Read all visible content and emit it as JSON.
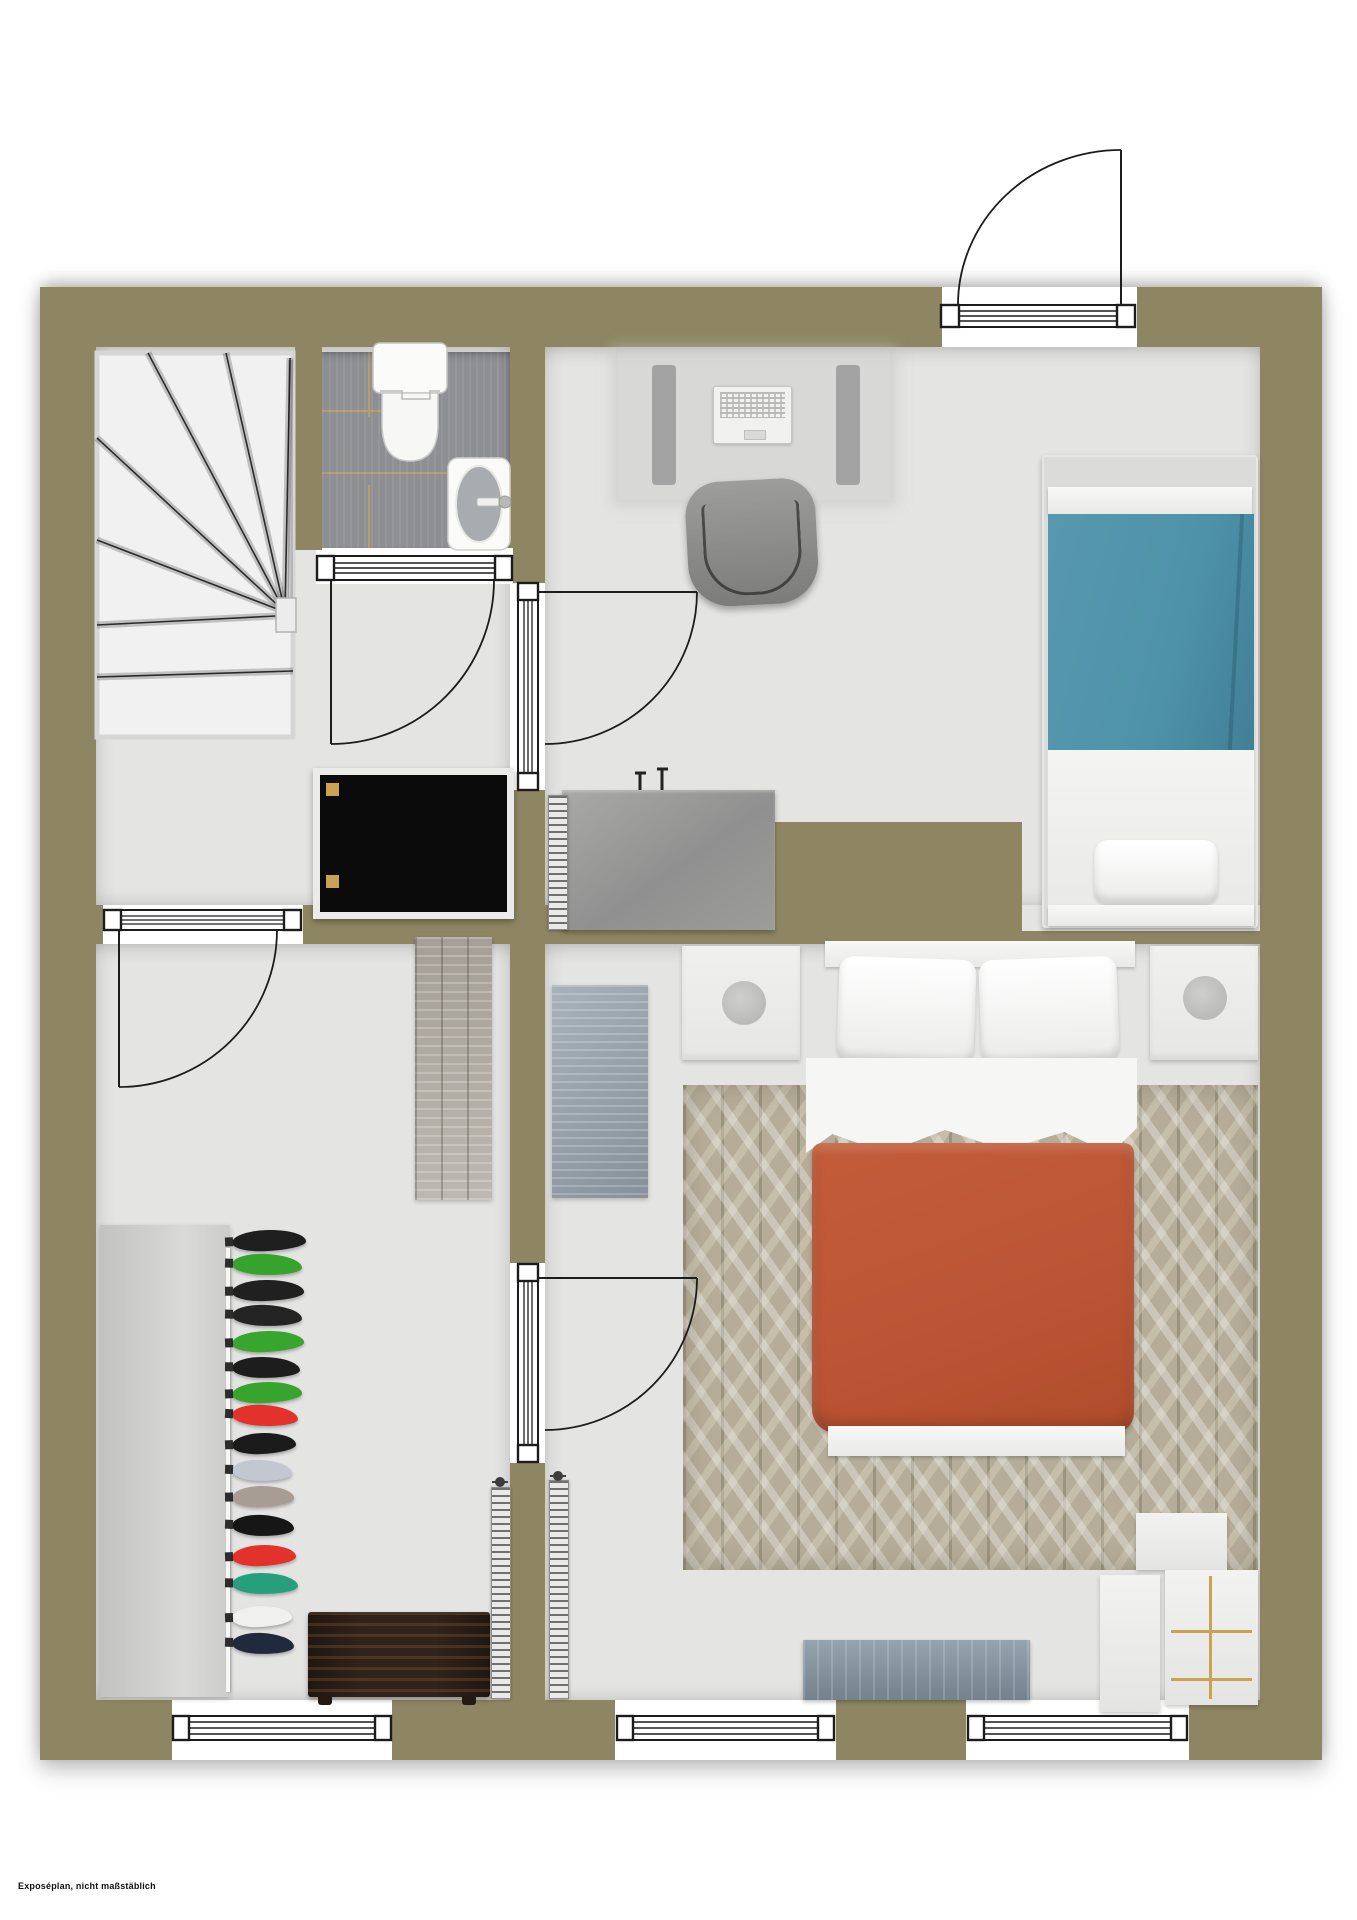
{
  "meta": {
    "disclaimer": "Exposéplan, nicht maßstäblich"
  },
  "palette": {
    "wall": "#8e8662",
    "floor": "#e4e4e3",
    "tile": "#8d8f93",
    "grout": "#b79c6c",
    "stair": "#f1f1f1",
    "bed_blue": "#4e92a9",
    "bed_orange": "#bc5535",
    "rug_bg": "#b5ad99",
    "wood": "#b5b0a8",
    "mat_blue": "#95a1ac",
    "cabinet": "#0b0b0b",
    "brass": "#c9a254",
    "chest": "#31231a",
    "table_blue": "#8494a1"
  },
  "icons": [
    "door-swing-icon",
    "window-sill-icon",
    "staircase-icon",
    "toilet-icon",
    "sink-icon",
    "radiator-icon",
    "lamp-icon",
    "clothes-hanger-icon"
  ],
  "clothes": {
    "items": [
      {
        "y": 2,
        "w": 74,
        "rot": -2,
        "color": "#1e1e1e"
      },
      {
        "y": 26,
        "w": 70,
        "rot": 2,
        "color": "#35a32c"
      },
      {
        "y": 52,
        "w": 72,
        "rot": -1,
        "color": "#202020"
      },
      {
        "y": 77,
        "w": 70,
        "rot": 2,
        "color": "#242424"
      },
      {
        "y": 103,
        "w": 72,
        "rot": -2,
        "color": "#38a52e"
      },
      {
        "y": 129,
        "w": 68,
        "rot": 1,
        "color": "#1d1d1d"
      },
      {
        "y": 154,
        "w": 70,
        "rot": -2,
        "color": "#36a42d"
      },
      {
        "y": 177,
        "w": 66,
        "rot": 3,
        "color": "#e2322b"
      },
      {
        "y": 205,
        "w": 64,
        "rot": -2,
        "color": "#1b1b1b"
      },
      {
        "y": 232,
        "w": 60,
        "rot": 2,
        "color": "#c2c7d2"
      },
      {
        "y": 258,
        "w": 62,
        "rot": -1,
        "color": "#a79d95"
      },
      {
        "y": 287,
        "w": 62,
        "rot": 2,
        "color": "#161616"
      },
      {
        "y": 317,
        "w": 64,
        "rot": -2,
        "color": "#e2322b"
      },
      {
        "y": 345,
        "w": 66,
        "rot": 1,
        "color": "#26a07c"
      },
      {
        "y": 378,
        "w": 60,
        "rot": -2,
        "color": "#f0f0ee"
      },
      {
        "y": 405,
        "w": 62,
        "rot": 2,
        "color": "#202a3c"
      }
    ]
  }
}
